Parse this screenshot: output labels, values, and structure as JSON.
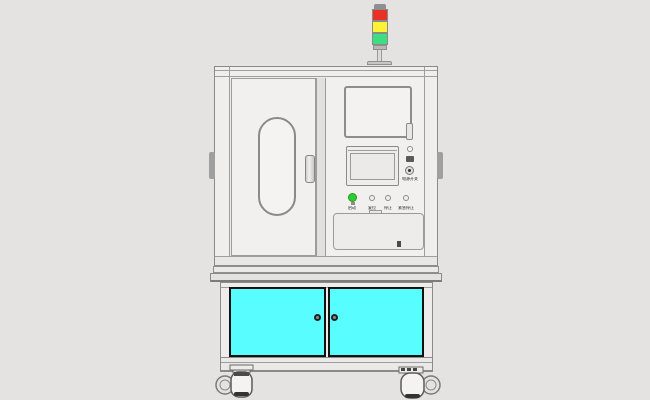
{
  "colors": {
    "background": "#e5e3e1",
    "cabinet_body": "#efeeed",
    "door_face": "#f1f0ef",
    "frame_line": "#8a8a8a",
    "cabinet_cyan": "#58feff",
    "door_border_dark": "#111111",
    "tower_red": "#e83226",
    "tower_yellow": "#fdf233",
    "tower_green": "#3fdd82",
    "button_green": "#2ecc2e",
    "knob_dark": "#212121",
    "side_tab_gray": "#9f9f9f"
  },
  "signal_tower": {
    "segments": [
      "red",
      "yellow",
      "green"
    ]
  },
  "control_panel": {
    "selector_label": "电源开关",
    "buttons": [
      {
        "label": "启动",
        "state": "on",
        "color": "#2ecc2e"
      },
      {
        "label": "复位",
        "state": "off"
      },
      {
        "label": "停止",
        "state": "off"
      },
      {
        "label": "紧急停止",
        "state": "off"
      }
    ]
  }
}
